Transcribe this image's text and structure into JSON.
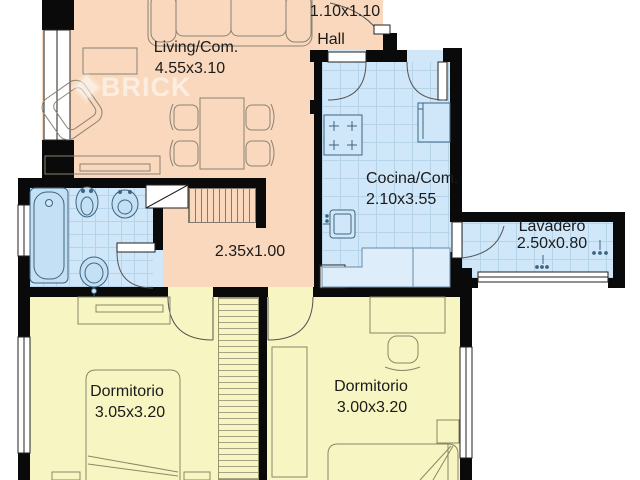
{
  "watermark": {
    "brand": "BRICK"
  },
  "rooms": {
    "living": {
      "label": "Living/Com.",
      "dims": "4.55x3.10"
    },
    "hall": {
      "label": "Hall",
      "dims": "1.10x1.10"
    },
    "kitchen": {
      "label": "Cocina/Com.",
      "dims": "2.10x3.55"
    },
    "laundry": {
      "label": "Lavadero",
      "dims": "2.50x0.80"
    },
    "corridor": {
      "dims": "2.35x1.00"
    },
    "bedroom_left": {
      "label": "Dormitorio",
      "dims": "3.05x3.20"
    },
    "bedroom_right": {
      "label": "Dormitorio",
      "dims": "3.00x3.20"
    }
  },
  "colors": {
    "social_floor": "#f9d8bd",
    "wet_floor": "#cfe7f8",
    "bedroom_floor": "#f7f5c1",
    "wall": "#0a0a0a"
  }
}
